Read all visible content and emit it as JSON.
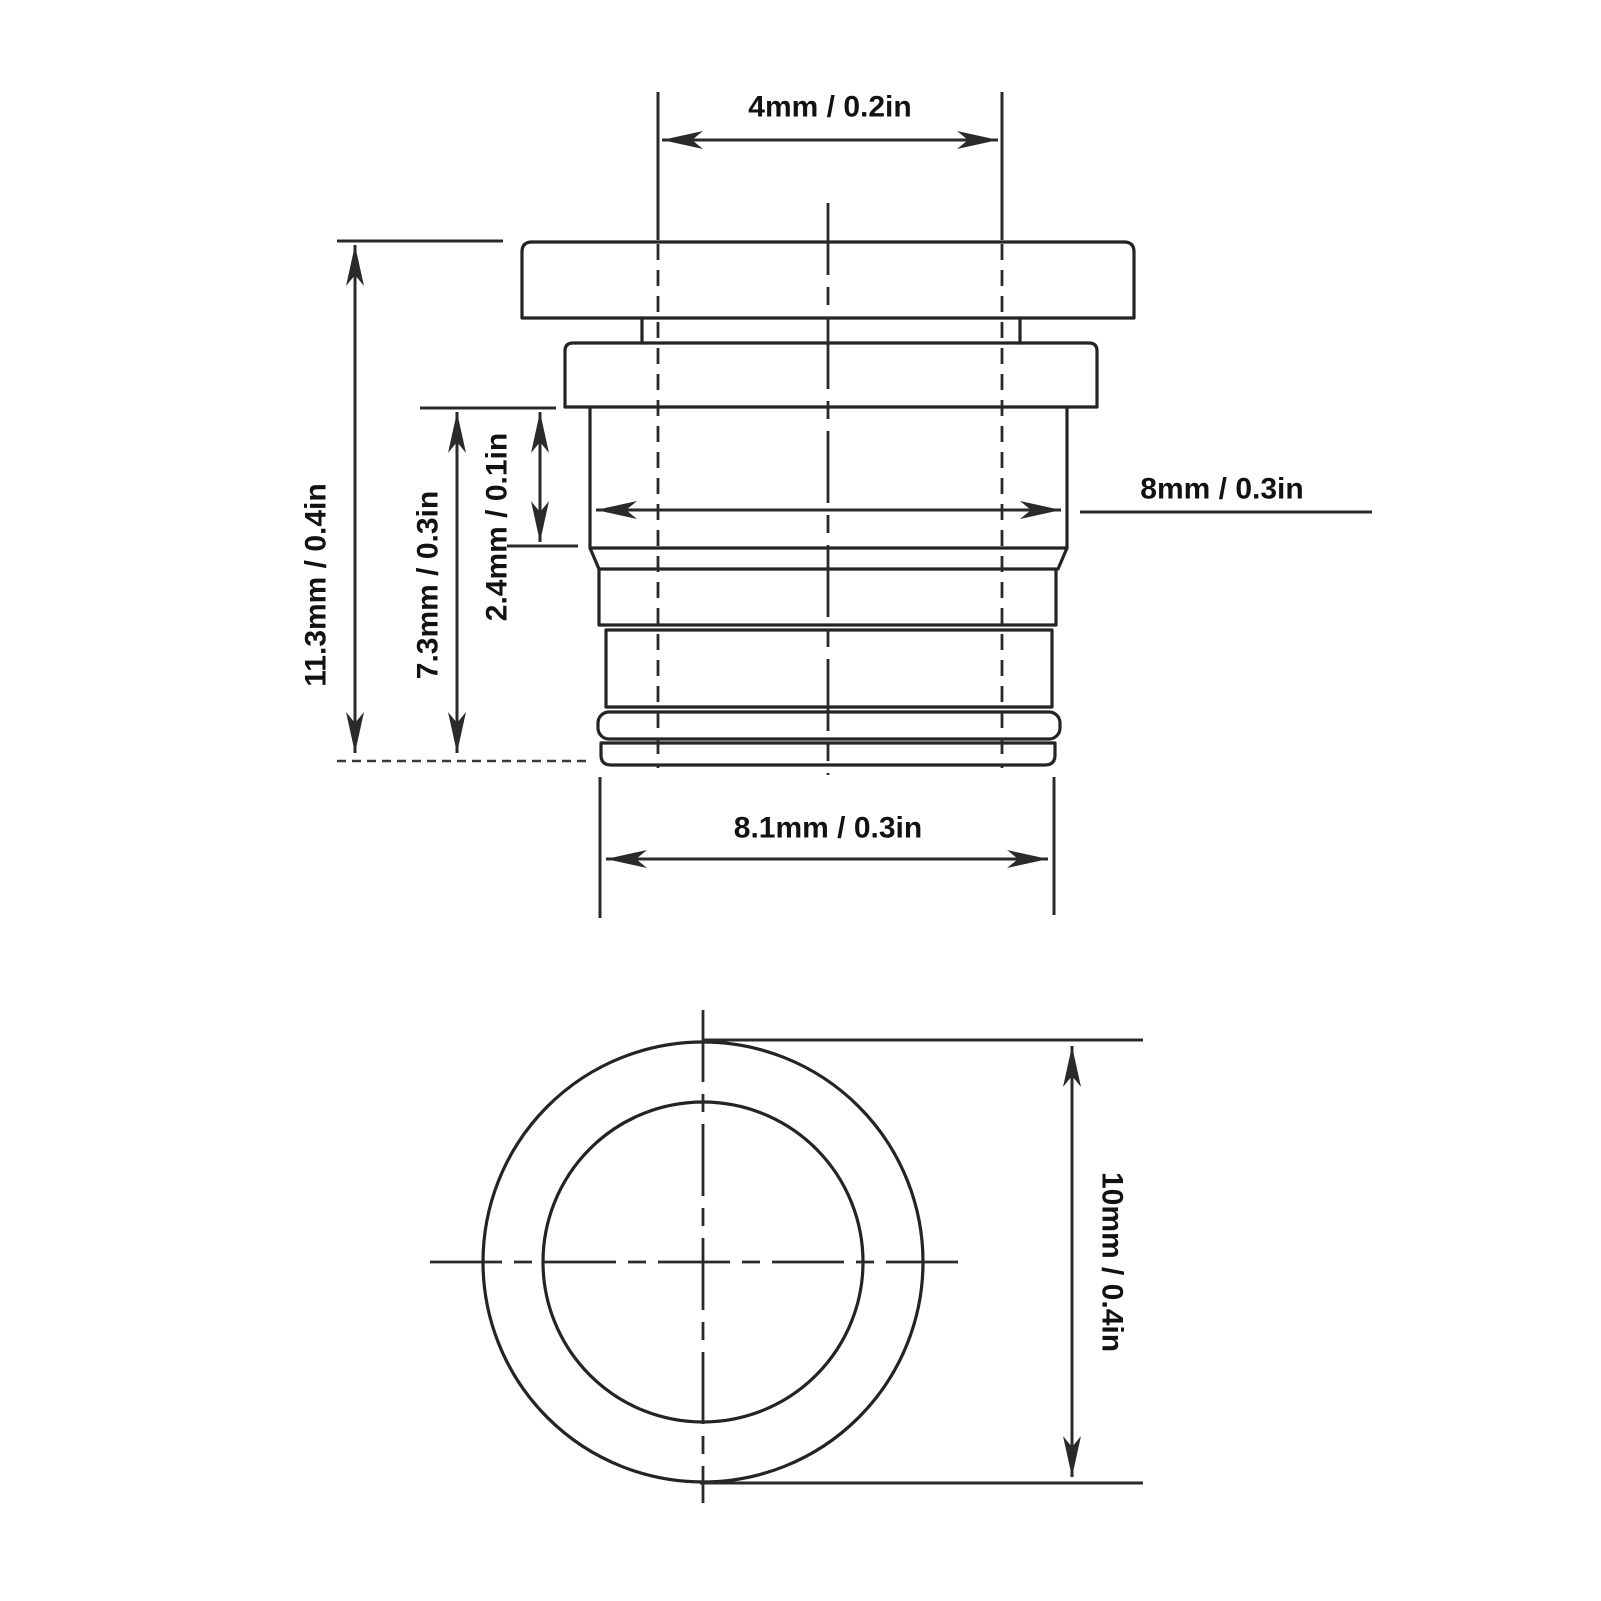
{
  "drawing": {
    "kind": "technical-dimension-drawing",
    "colors": {
      "background": "#ffffff",
      "line": "#242424",
      "text": "#121212"
    },
    "dimensions": {
      "top_width": {
        "label": "4mm / 0.2in"
      },
      "body_width": {
        "label": "8mm / 0.3in"
      },
      "total_height": {
        "label": "11.3mm / 0.4in"
      },
      "body_height": {
        "label": "7.3mm / 0.3in"
      },
      "step_height": {
        "label": "2.4mm / 0.1in"
      },
      "bottom_width": {
        "label": "8.1mm / 0.3in"
      },
      "outer_diameter": {
        "label": "10mm / 0.4in"
      }
    }
  }
}
